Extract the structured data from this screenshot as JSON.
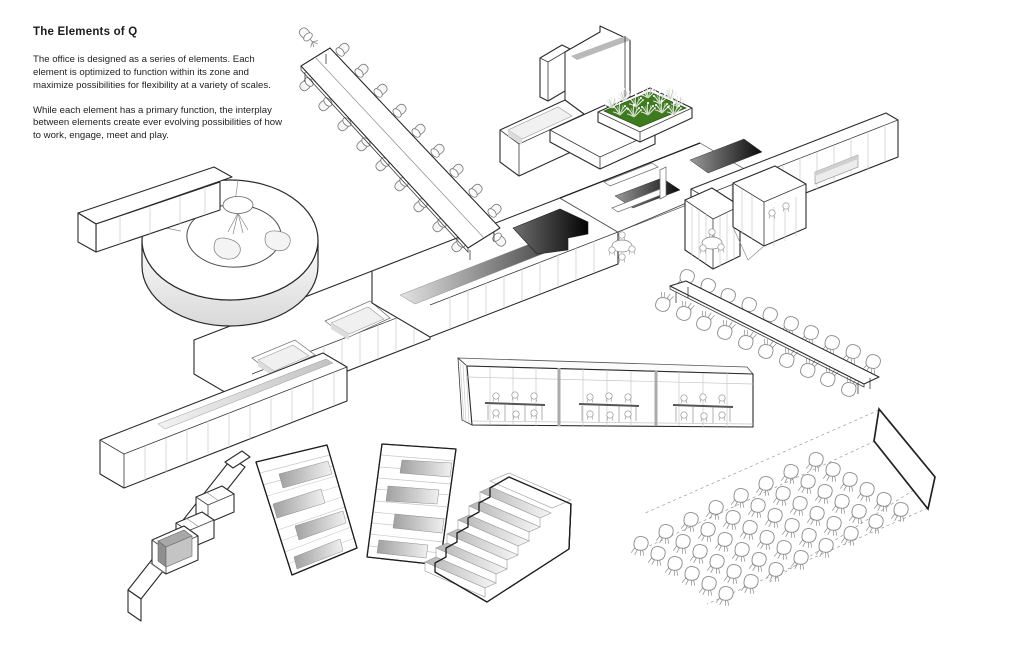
{
  "header": {
    "title": "The Elements of Q",
    "paragraphs": [
      "The office is designed as a series of elements. Each element is optimized to function within its zone and maximize possibilities for flexibility at a variety of scales.",
      "While each element has a primary function, the interplay between elements create ever evolving possibilities of how to work, engage, meet and play."
    ]
  },
  "figures": [
    "conference-table-long",
    "lounge-planter-unit",
    "spiral-bench",
    "storage-spine",
    "meeting-pods",
    "shelf-wall",
    "long-dining-table",
    "glass-meeting-rooms",
    "zigzag-bench",
    "tiered-seating-left",
    "tiered-seating-right",
    "stepped-seating",
    "audience-chairs",
    "projection-screen"
  ],
  "colors": {
    "background": "#ffffff",
    "outline": "#1e1e1e",
    "light_line": "#c7c7c7",
    "planter_green": "#3e7a1e",
    "recess_dark": "#050505",
    "cushion_gray": "#a8a8a8"
  }
}
